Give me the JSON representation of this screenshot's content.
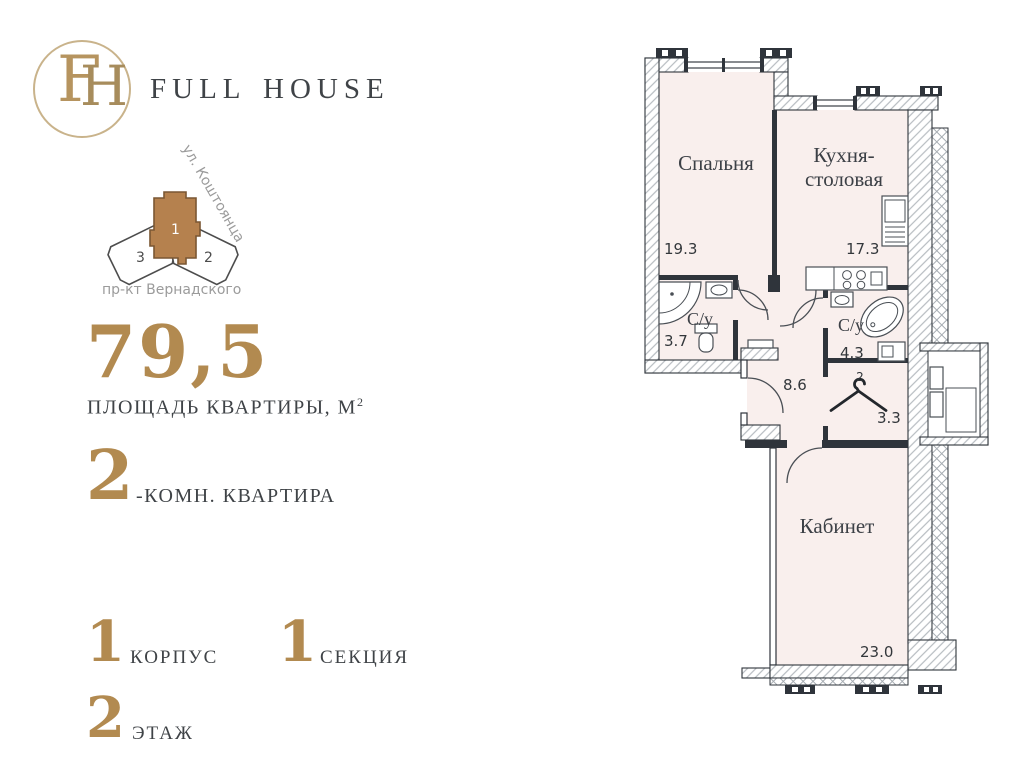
{
  "brand": {
    "name_display": "Full House",
    "monogram": {
      "letter_f": "F",
      "letter_h": "H"
    }
  },
  "site_plan": {
    "street_top": "ул. Коштоянца",
    "street_bottom": "пр-кт Вернадского",
    "buildings": [
      {
        "number": "1",
        "highlighted": true
      },
      {
        "number": "3",
        "highlighted": false
      },
      {
        "number": "2",
        "highlighted": false
      }
    ]
  },
  "apartment": {
    "area_value": "79,5",
    "area_label": "ПЛОЩАДЬ КВАРТИРЫ, М",
    "area_superscript": "2",
    "rooms_value": "2",
    "rooms_label": "-КОМН. КВАРТИРА",
    "building_value": "1",
    "building_label": "КОРПУС",
    "section_value": "1",
    "section_label": "СЕКЦИЯ",
    "floor_value": "2",
    "floor_label": "ЭТАЖ"
  },
  "floor_plan": {
    "bedroom": {
      "label": "Спальня",
      "area": "19.3"
    },
    "kitchen": {
      "label_line1": "Кухня-",
      "label_line2": "столовая",
      "area": "17.3"
    },
    "bathroom_1": {
      "label": "С/у",
      "area": "3.7"
    },
    "bathroom_2": {
      "label": "С/у",
      "area": "4.3"
    },
    "hallway": {
      "area": "8.6"
    },
    "wardrobe": {
      "area": "3.3",
      "mark": "2"
    },
    "study": {
      "label": "Кабинет",
      "area": "23.0"
    }
  },
  "colors": {
    "accent_gold": "#b28a50",
    "building_brown": "#b5814e",
    "text_dark": "#3f4347",
    "text_gray": "#9b9b9b",
    "plan_fill": "#f9efed",
    "wall_dark": "#2f343b"
  }
}
